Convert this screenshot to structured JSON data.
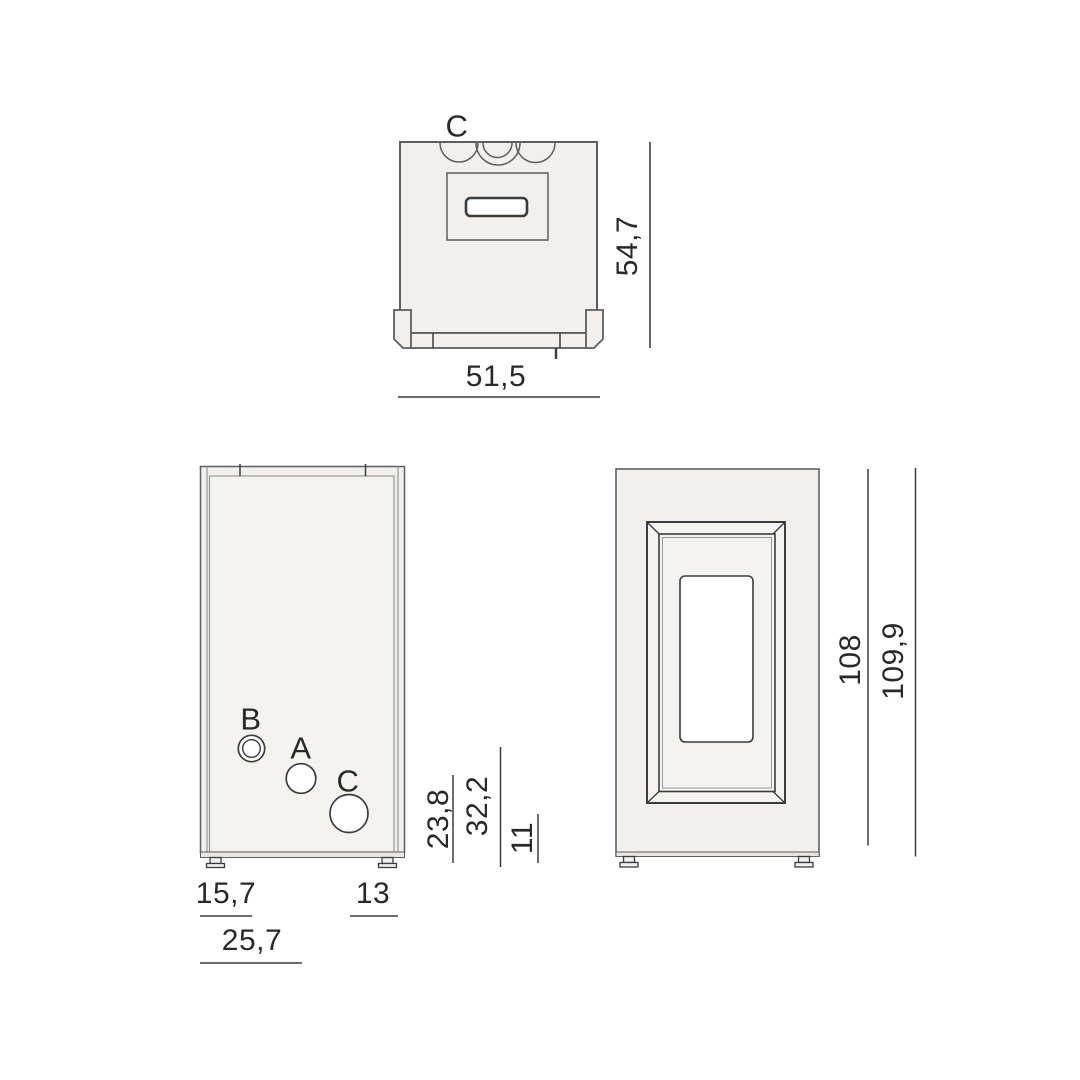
{
  "drawing": {
    "top_view": {
      "connector_label": "C",
      "dim_width": "51,5",
      "dim_depth": "54,7"
    },
    "back_view": {
      "connection_labels": {
        "b": "B",
        "a": "A",
        "c": "C"
      },
      "dims_vertical": {
        "first": "23,8",
        "second": "32,2",
        "third": "11"
      },
      "dims_horizontal": {
        "left": "15,7",
        "right": "13",
        "total": "25,7"
      }
    },
    "front_view": {
      "dim_height_body": "108",
      "dim_height_total": "109,9"
    }
  },
  "colors": {
    "background": "#ffffff",
    "body_fill": "#f2efec",
    "body_fill_light": "#f5f3f0",
    "band_fill": "#e9e6e3",
    "line_dark": "#3a3d3f",
    "line_mid": "#5c5f62",
    "line_light": "#96999c",
    "text": "#28292a"
  }
}
